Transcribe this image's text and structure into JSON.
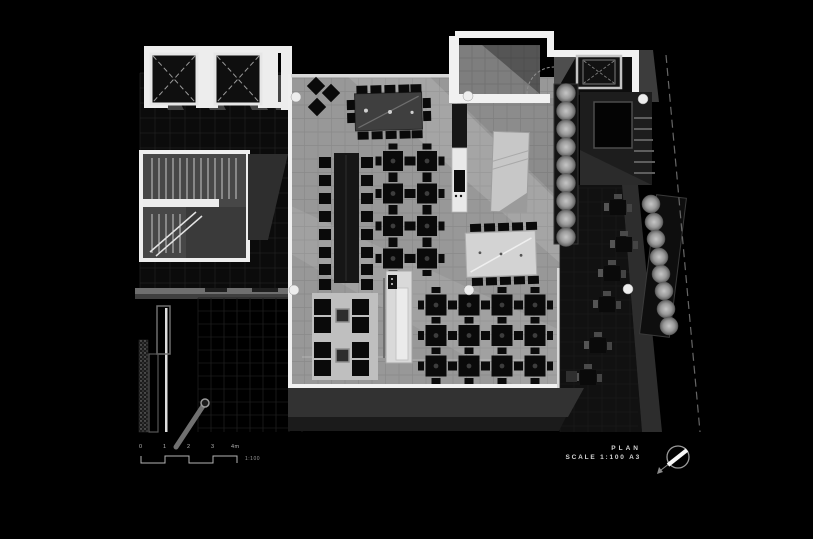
{
  "title_block": {
    "title": "PLAN",
    "scale_label": "SCALE 1:100 A3"
  },
  "scale_bar": {
    "ticks": [
      "0",
      "1",
      "2",
      "3",
      "4m"
    ],
    "ratio": "1:100"
  },
  "icons": {
    "north_arrow": "north-arrow-icon"
  },
  "palette": {
    "background": "#000000",
    "floor": "#989898",
    "wall": "#f1f1f1",
    "furniture": "#0a0a0a",
    "communal_table_dark": "#3f3f3f",
    "communal_table_light": "#d3d3d3",
    "rug": "#bfbfbf",
    "bar": "#d9d9d9",
    "terrace": "#323232",
    "tree_light": "#c6c6c6",
    "tree_dark": "#5f5f5f",
    "text": "#cfcfcf"
  },
  "plan": {
    "grids": [
      {
        "parent": "grid-lobby",
        "x": 140,
        "y": 73,
        "w": 150,
        "h": 218,
        "step": 15,
        "stroke": "#1f1f1f",
        "sw": 0.8
      },
      {
        "parent": "grid-court",
        "x": 198,
        "y": 298,
        "w": 104,
        "h": 134,
        "step": 13,
        "stroke": "#1d1d1d",
        "sw": 0.8
      },
      {
        "parent": "grid-dining",
        "x": 291,
        "y": 78,
        "w": 269,
        "h": 307,
        "step": 13.5,
        "stroke": "rgba(0,0,0,0.09)",
        "sw": 0.7
      },
      {
        "parent": "grid-entry",
        "x": 459,
        "y": 45,
        "w": 81,
        "h": 49,
        "step": 13,
        "stroke": "rgba(0,0,0,0.12)",
        "sw": 0.7
      },
      {
        "parent": "grid-ext",
        "x": 560,
        "y": 188,
        "w": 78,
        "h": 244,
        "step": 14,
        "stroke": "#1a1a1a",
        "sw": 0.8
      }
    ],
    "table_grids": [
      {
        "parent": "table-grid-left",
        "cx": 393,
        "cy": 161,
        "cols": 2,
        "rows": 4,
        "dx": 34,
        "dy": 32.5,
        "size": 20
      },
      {
        "parent": "table-grid-right",
        "cx": 436,
        "cy": 305,
        "cols": 4,
        "rows": 3,
        "dx": 33,
        "dy": 30.5,
        "size": 21
      }
    ],
    "banquette": {
      "chair_ys": [
        157,
        175,
        193,
        211,
        229,
        247,
        264,
        279
      ],
      "left_x": 319,
      "right_x": 361,
      "w": 12,
      "h": 11
    },
    "communal_top": {
      "chair_xs": [
        357,
        371,
        385,
        399,
        411
      ],
      "top_y": 85,
      "bottom_y": 131,
      "chair_w": 11,
      "chair_h": 8,
      "side_left_x": 347,
      "side_right_x": 423,
      "side_ys": [
        99,
        112
      ],
      "side_w": 8,
      "side_h": 10
    },
    "communal_right": {
      "chair_xs": [
        471,
        485,
        499,
        513,
        527
      ],
      "top_y": 223,
      "bottom_y": 277,
      "chair_w": 11,
      "chair_h": 8
    },
    "lounge_chairs": [
      [
        314,
        299
      ],
      [
        352,
        299
      ],
      [
        314,
        317
      ],
      [
        352,
        317
      ],
      [
        314,
        342
      ],
      [
        352,
        342
      ],
      [
        314,
        360
      ],
      [
        352,
        360
      ]
    ],
    "lounge_chair_size": [
      17,
      16
    ],
    "diamond_tables": [
      [
        316,
        86
      ],
      [
        331,
        93
      ],
      [
        317,
        107
      ]
    ],
    "trees_upper": {
      "x": 566,
      "ys": [
        93,
        111,
        129,
        147,
        165,
        183,
        201,
        219,
        237
      ],
      "r": 9.5
    },
    "trees_right": {
      "points": [
        [
          651,
          204
        ],
        [
          654,
          222
        ],
        [
          656,
          239
        ],
        [
          659,
          257
        ],
        [
          661,
          274
        ],
        [
          664,
          291
        ],
        [
          666,
          309
        ],
        [
          669,
          326
        ]
      ],
      "r": 9
    },
    "outdoor_tables": [
      [
        610,
        200
      ],
      [
        616,
        237
      ],
      [
        604,
        266
      ],
      [
        599,
        297
      ],
      [
        590,
        338
      ],
      [
        580,
        370
      ]
    ],
    "columns": [
      [
        296,
        97
      ],
      [
        468,
        96
      ],
      [
        294,
        290
      ],
      [
        469,
        290
      ],
      [
        643,
        99
      ],
      [
        628,
        289
      ]
    ]
  }
}
